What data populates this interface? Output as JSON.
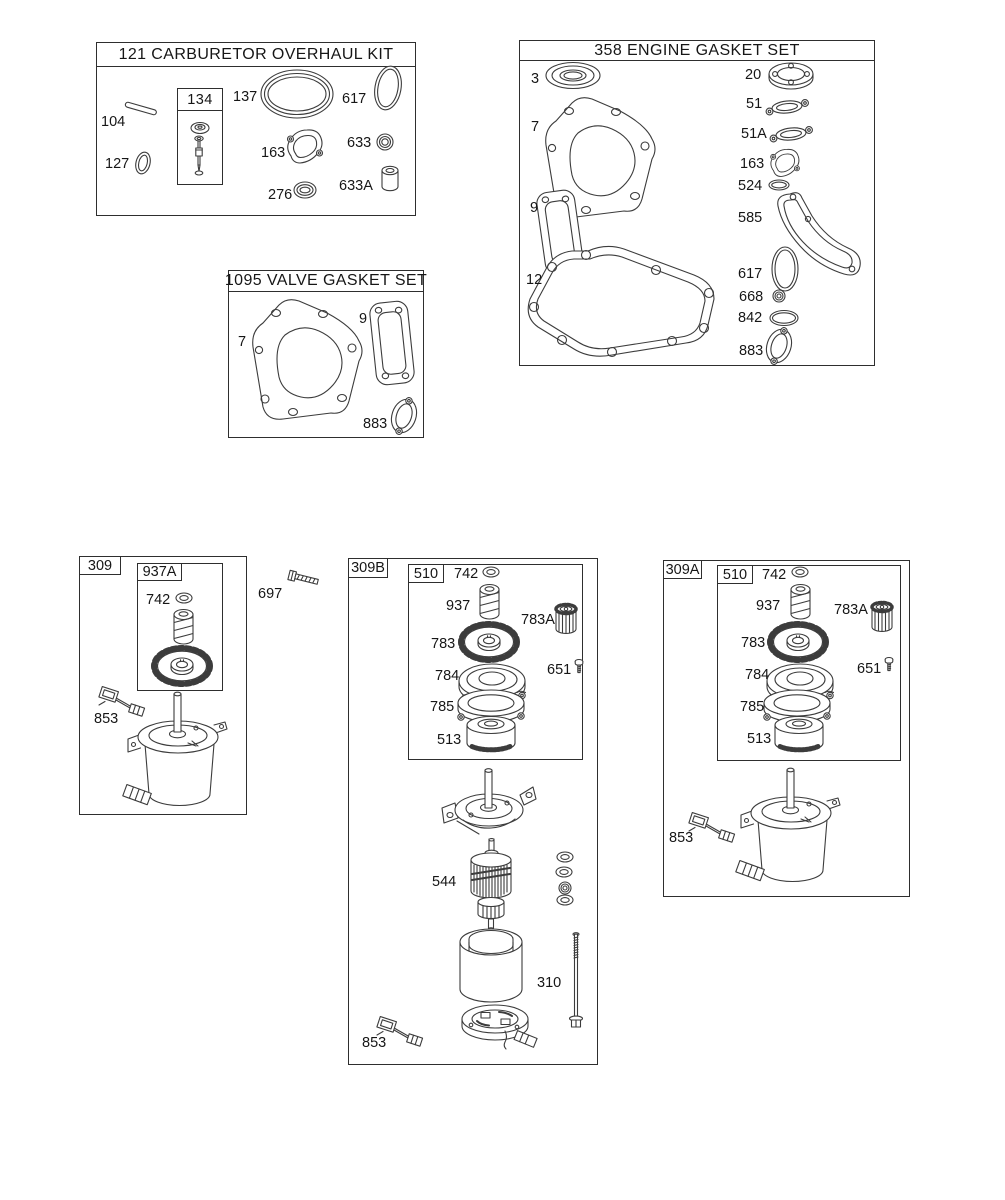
{
  "diagram": {
    "sections": {
      "carb_kit": {
        "title": "121 CARBURETOR OVERHAUL KIT",
        "box134_label": "134",
        "parts": {
          "n104": "104",
          "n127": "127",
          "n137": "137",
          "n617": "617",
          "n163": "163",
          "n633": "633",
          "n276": "276",
          "n633A": "633A"
        }
      },
      "engine_gasket_set": {
        "title": "358 ENGINE GASKET SET",
        "parts": {
          "n3": "3",
          "n7": "7",
          "n9": "9",
          "n12": "12",
          "n20": "20",
          "n51": "51",
          "n51A": "51A",
          "n163": "163",
          "n524": "524",
          "n585": "585",
          "n617": "617",
          "n668": "668",
          "n842": "842",
          "n883": "883"
        }
      },
      "valve_gasket_set": {
        "title": "1095 VALVE GASKET SET",
        "parts": {
          "n7": "7",
          "n9": "9",
          "n883": "883"
        }
      },
      "starter_309": {
        "tag": "309",
        "subassembly_label": "937A",
        "parts": {
          "n742": "742",
          "n853": "853"
        }
      },
      "loose_hardware": {
        "n697": "697"
      },
      "starter_309B": {
        "tag": "309B",
        "subassembly_label": "510",
        "parts": {
          "n742": "742",
          "n937": "937",
          "n783A": "783A",
          "n783": "783",
          "n651": "651",
          "n784": "784",
          "n785": "785",
          "n513": "513",
          "n544": "544",
          "n310": "310",
          "n853": "853"
        }
      },
      "starter_309A": {
        "tag": "309A",
        "subassembly_label": "510",
        "parts": {
          "n742": "742",
          "n937": "937",
          "n783A": "783A",
          "n783": "783",
          "n651": "651",
          "n784": "784",
          "n785": "785",
          "n513": "513",
          "n853": "853"
        }
      }
    }
  }
}
